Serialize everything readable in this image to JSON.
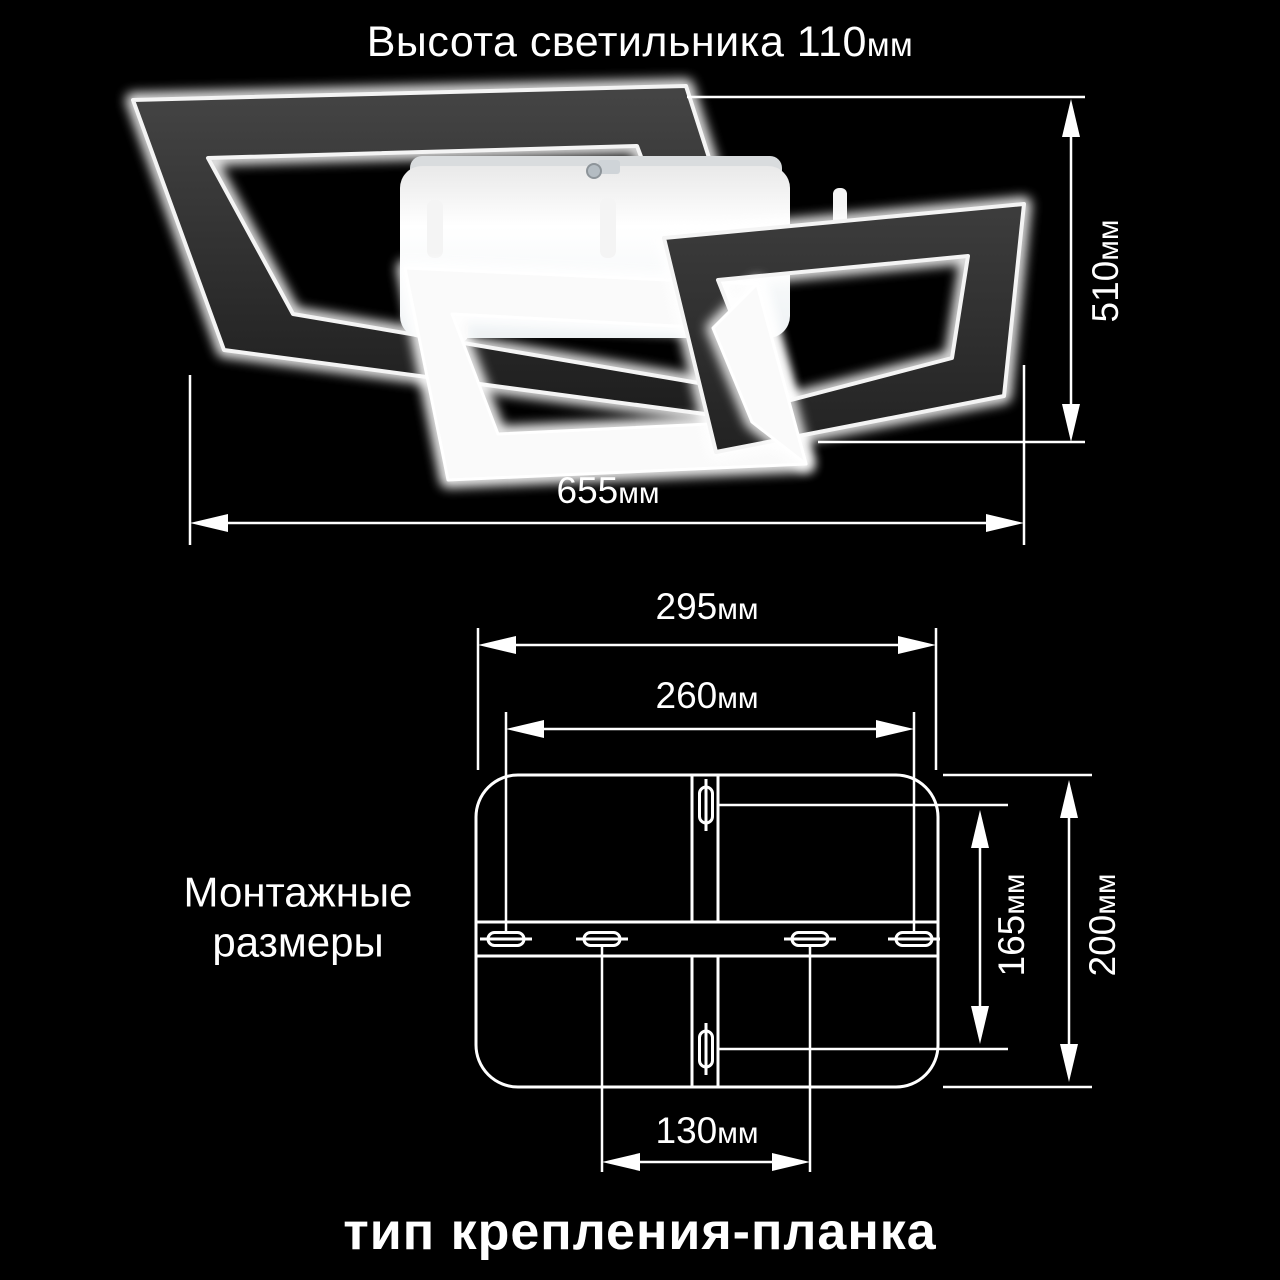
{
  "title": {
    "value": "Высота светильника 110",
    "unit": "мм"
  },
  "fixture": {
    "width": {
      "value": "655",
      "unit": "мм"
    },
    "height": {
      "value": "510",
      "unit": "мм"
    }
  },
  "mounting": {
    "heading_line1": "Монтажные",
    "heading_line2": "размеры",
    "outer_width": {
      "value": "295",
      "unit": "мм"
    },
    "slot_span_width": {
      "value": "260",
      "unit": "мм"
    },
    "slot_span_inner": {
      "value": "130",
      "unit": "мм"
    },
    "slot_span_height": {
      "value": "165",
      "unit": "мм"
    },
    "outer_height": {
      "value": "200",
      "unit": "мм"
    }
  },
  "footer": {
    "caption": "тип крепления-планка"
  },
  "colors": {
    "background": "#000000",
    "lines": "#ffffff",
    "frame_dark": "#2e2e2e",
    "frame_glow": "#ffffff",
    "canopy": "#f2f2f2"
  }
}
